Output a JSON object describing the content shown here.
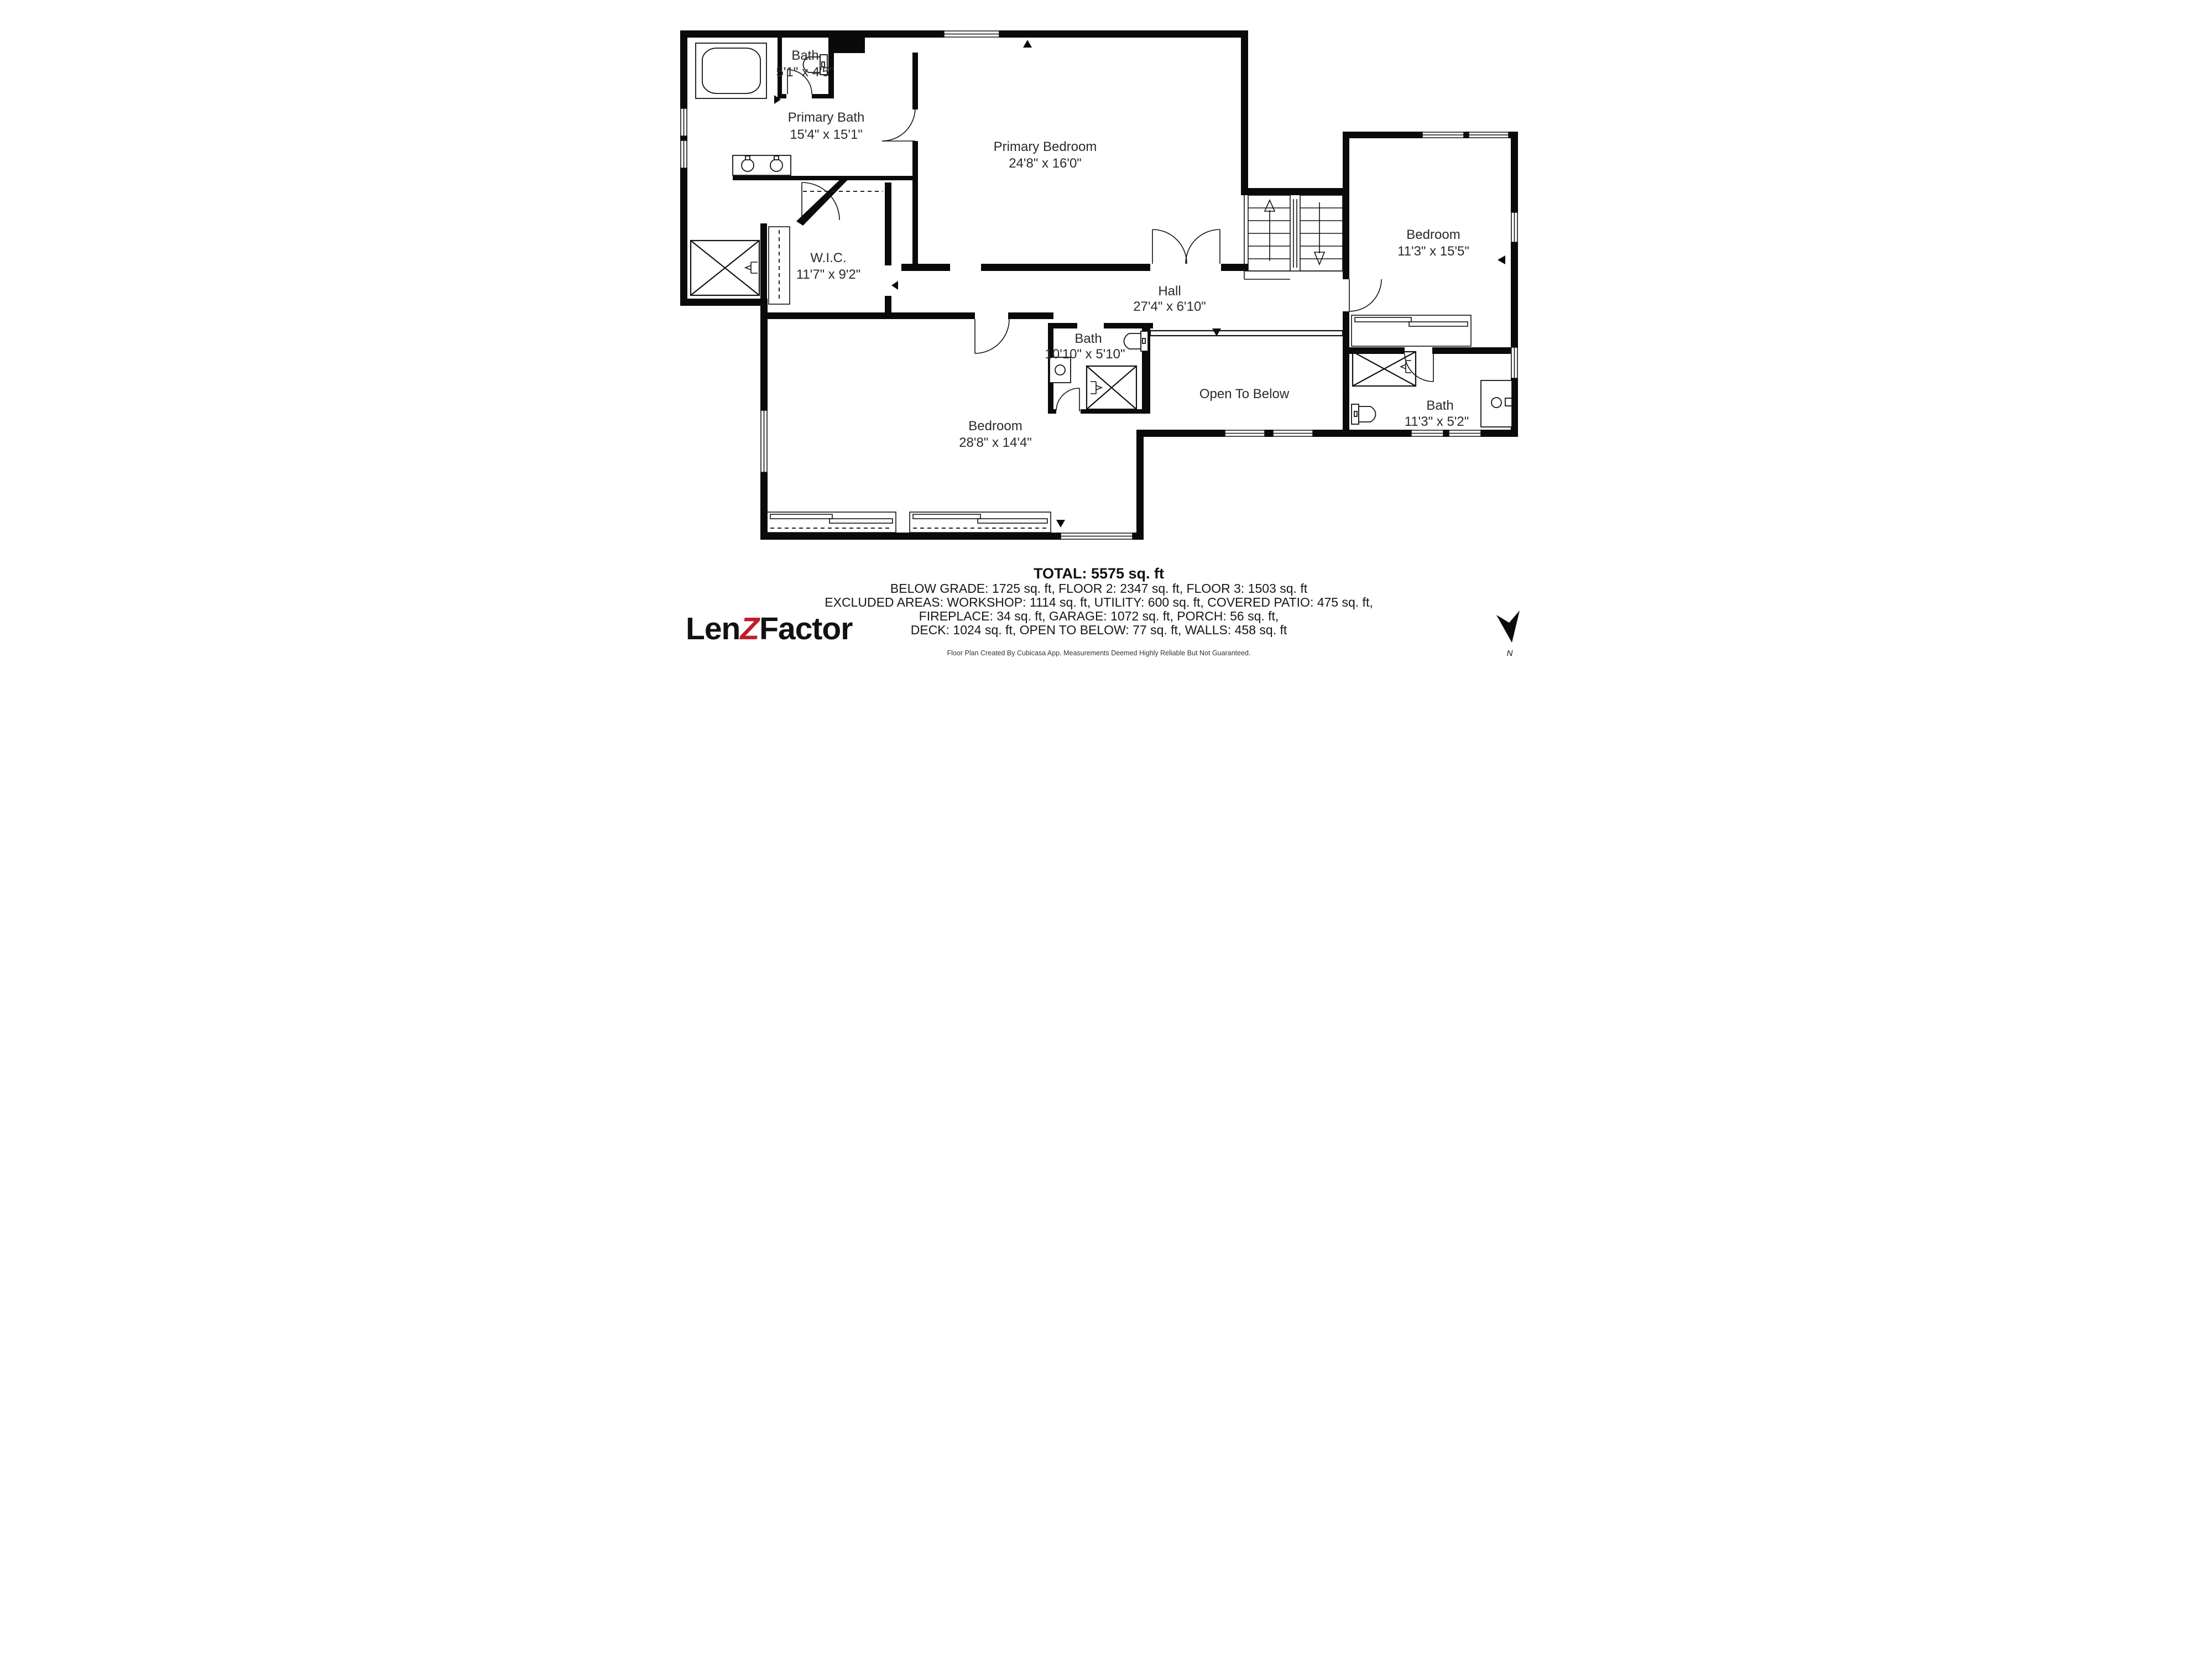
{
  "plan": {
    "rooms": {
      "bath_small": {
        "name": "Bath",
        "dims": "5'1\" x 4'5\""
      },
      "primary_bath": {
        "name": "Primary Bath",
        "dims": "15'4\" x 15'1\""
      },
      "primary_bedroom": {
        "name": "Primary Bedroom",
        "dims": "24'8\" x 16'0\""
      },
      "wic": {
        "name": "W.I.C.",
        "dims": "11'7\" x 9'2\""
      },
      "bedroom_right": {
        "name": "Bedroom",
        "dims": "11'3\" x 15'5\""
      },
      "hall": {
        "name": "Hall",
        "dims": "27'4\" x 6'10\""
      },
      "bath_center": {
        "name": "Bath",
        "dims": "10'10\" x 5'10\""
      },
      "open_to_below": {
        "label": "Open To Below"
      },
      "bedroom_left": {
        "name": "Bedroom",
        "dims": "28'8\" x 14'4\""
      },
      "bath_right": {
        "name": "Bath",
        "dims": "11'3\" x 5'2\""
      }
    },
    "north_label": "N"
  },
  "summary": {
    "total": "TOTAL: 5575 sq. ft",
    "line1": "BELOW GRADE: 1725 sq. ft, FLOOR 2: 2347 sq. ft, FLOOR 3: 1503 sq. ft",
    "line2": "EXCLUDED AREAS: WORKSHOP: 1114 sq. ft, UTILITY: 600 sq. ft, COVERED PATIO: 475 sq. ft,",
    "line3": "FIREPLACE: 34 sq. ft, GARAGE: 1072 sq. ft, PORCH: 56 sq. ft,",
    "line4": "DECK: 1024 sq. ft, OPEN TO BELOW: 77 sq. ft, WALLS: 458 sq. ft",
    "disclaimer": "Floor Plan Created By Cubicasa App. Measurements Deemed Highly Reliable But Not Guaranteed."
  },
  "branding": {
    "logo_len": "Len",
    "logo_z": "Z",
    "logo_factor": "Factor",
    "accent_color": "#be1e2d"
  }
}
